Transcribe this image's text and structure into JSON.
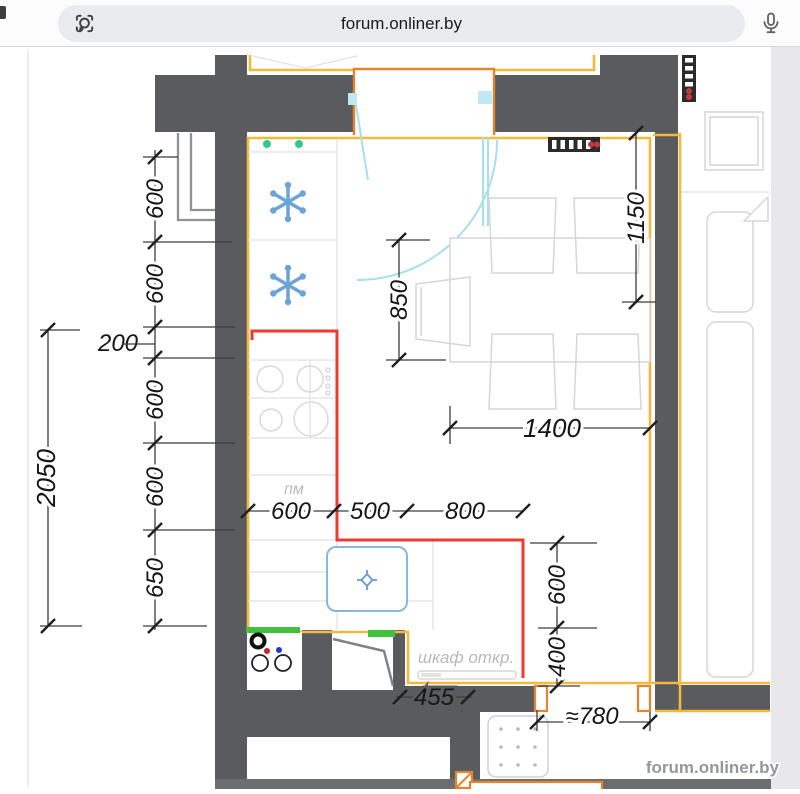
{
  "browser": {
    "address": "forum.onliner.by",
    "left_icon": "lens-icon",
    "right_icon": "microphone-icon"
  },
  "watermark": "forum.onliner.by",
  "plan": {
    "dims": {
      "left_chain": [
        "600",
        "600",
        "200",
        "600",
        "600",
        "650"
      ],
      "left_total": "2050",
      "table_depth": "850",
      "right_top": "1150",
      "table_width": "1400",
      "bottom_chain": [
        "600",
        "500",
        "800"
      ],
      "right_chain": [
        "600",
        "400"
      ],
      "niche": "455",
      "doorway": "≈780"
    },
    "labels": {
      "dishwasher": "пм",
      "cabinet": "шкаф откр."
    }
  },
  "colors": {
    "wall": "#595b5e",
    "wall_dark": "#6b6d70",
    "yellow": "#f2b93c",
    "orange": "#e2852e",
    "red": "#ee3a30",
    "cyan": "#a5e1ec",
    "cyan_fill": "#bfe9f1",
    "blue": "#6ba3d6",
    "sink_blue": "#8ab6da",
    "green_bar": "#41c13d",
    "green_dot": "#2fc98f",
    "radiator_red": "#c4373b",
    "furniture": "#d6d6d6",
    "band": "#e8e8eb"
  }
}
